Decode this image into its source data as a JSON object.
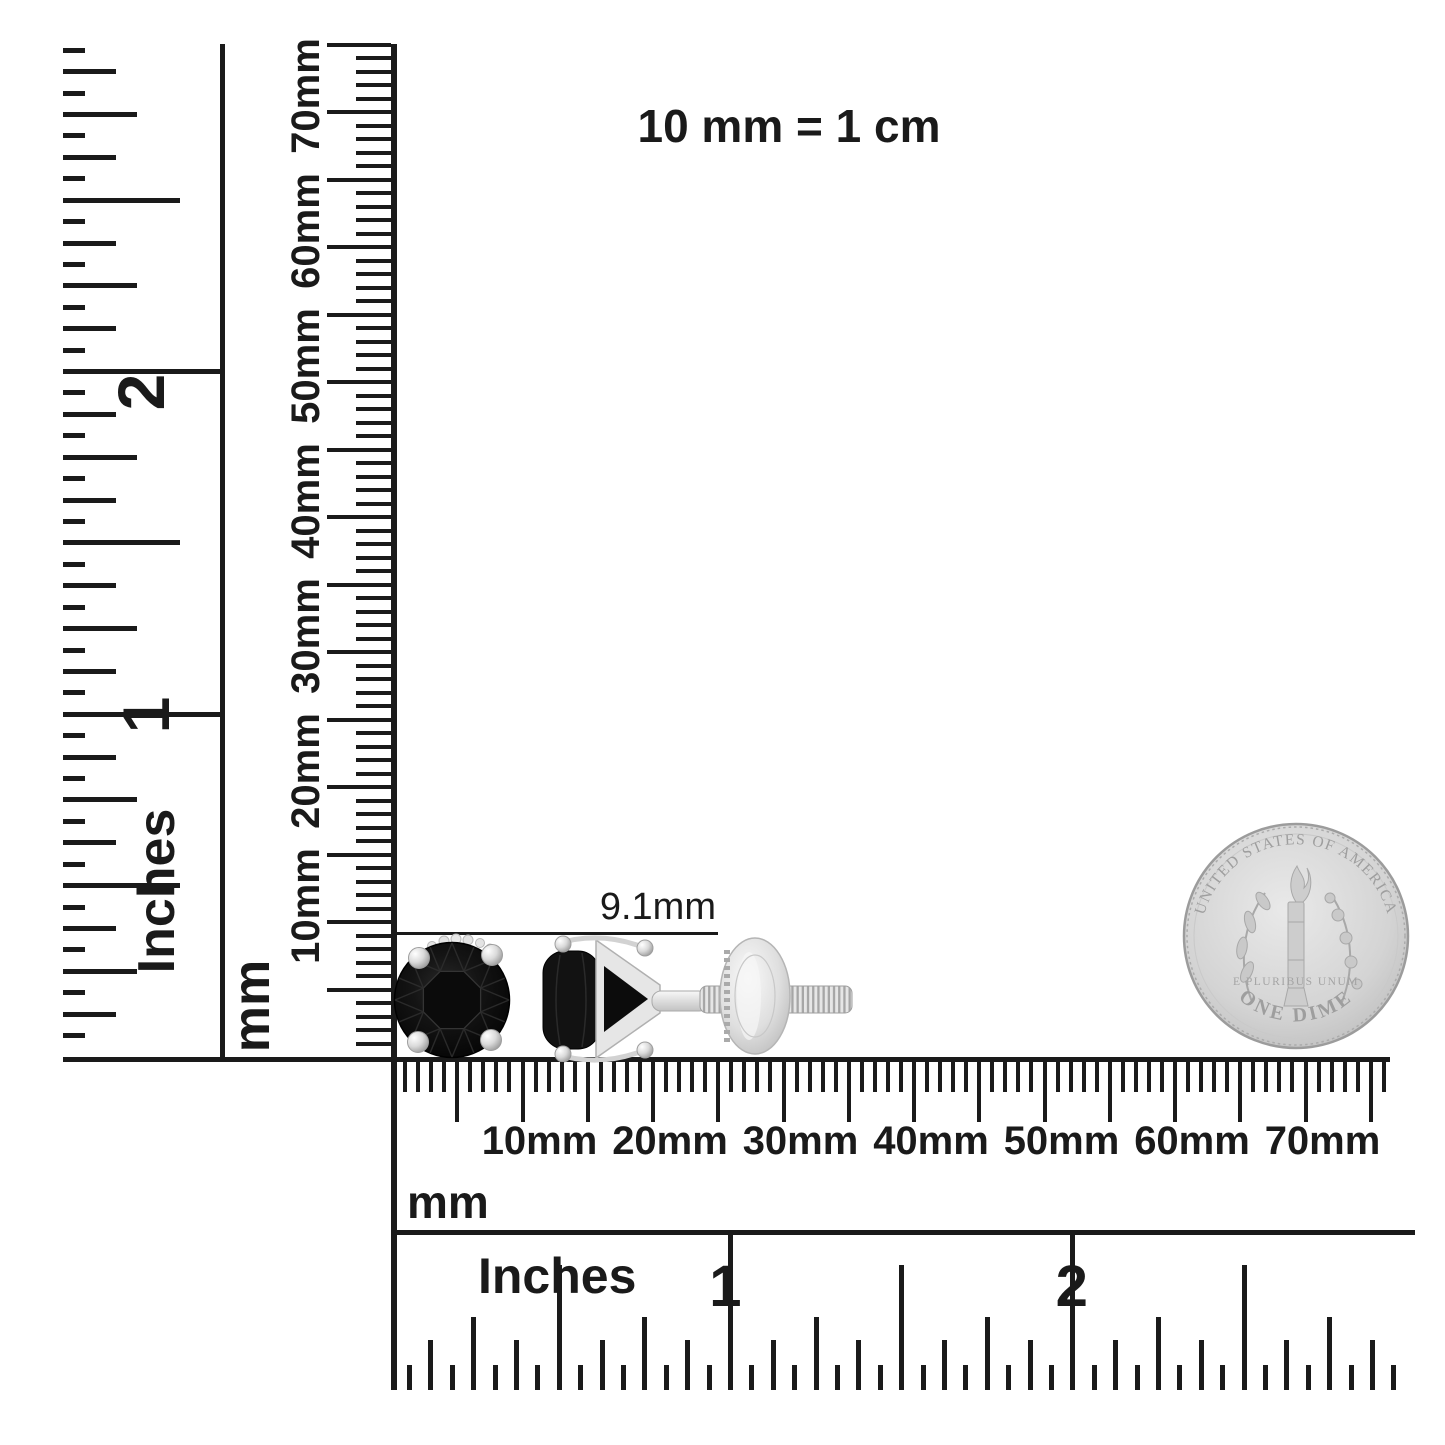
{
  "scale_note": "10 mm = 1 cm",
  "annotation": {
    "size_label": "9.1mm"
  },
  "rulers": {
    "left_inches": {
      "unit": "Inches",
      "numbers": [
        "1",
        "2"
      ]
    },
    "vertical_mm": {
      "unit": "mm",
      "labels": [
        "10mm",
        "20mm",
        "30mm",
        "40mm",
        "50mm",
        "60mm",
        "70mm"
      ]
    },
    "bottom_mm": {
      "unit": "mm",
      "labels": [
        "10mm",
        "20mm",
        "30mm",
        "40mm",
        "50mm",
        "60mm",
        "70mm"
      ]
    },
    "bottom_inches": {
      "unit": "Inches",
      "numbers": [
        "1",
        "2"
      ]
    }
  },
  "coin": {
    "legend_top": "UNITED STATES OF AMERICA",
    "motto": "E PLURIBUS UNUM",
    "denomination": "ONE DIME"
  },
  "colors": {
    "ink": "#1a1a1a",
    "stone_black": "#101010",
    "metal_light": "#f2f2f2",
    "metal_mid": "#cfcfcf",
    "metal_dark": "#9a9a9a",
    "coin_face": "#d6d6d6",
    "coin_detail": "#9e9e9e",
    "background": "#ffffff"
  }
}
